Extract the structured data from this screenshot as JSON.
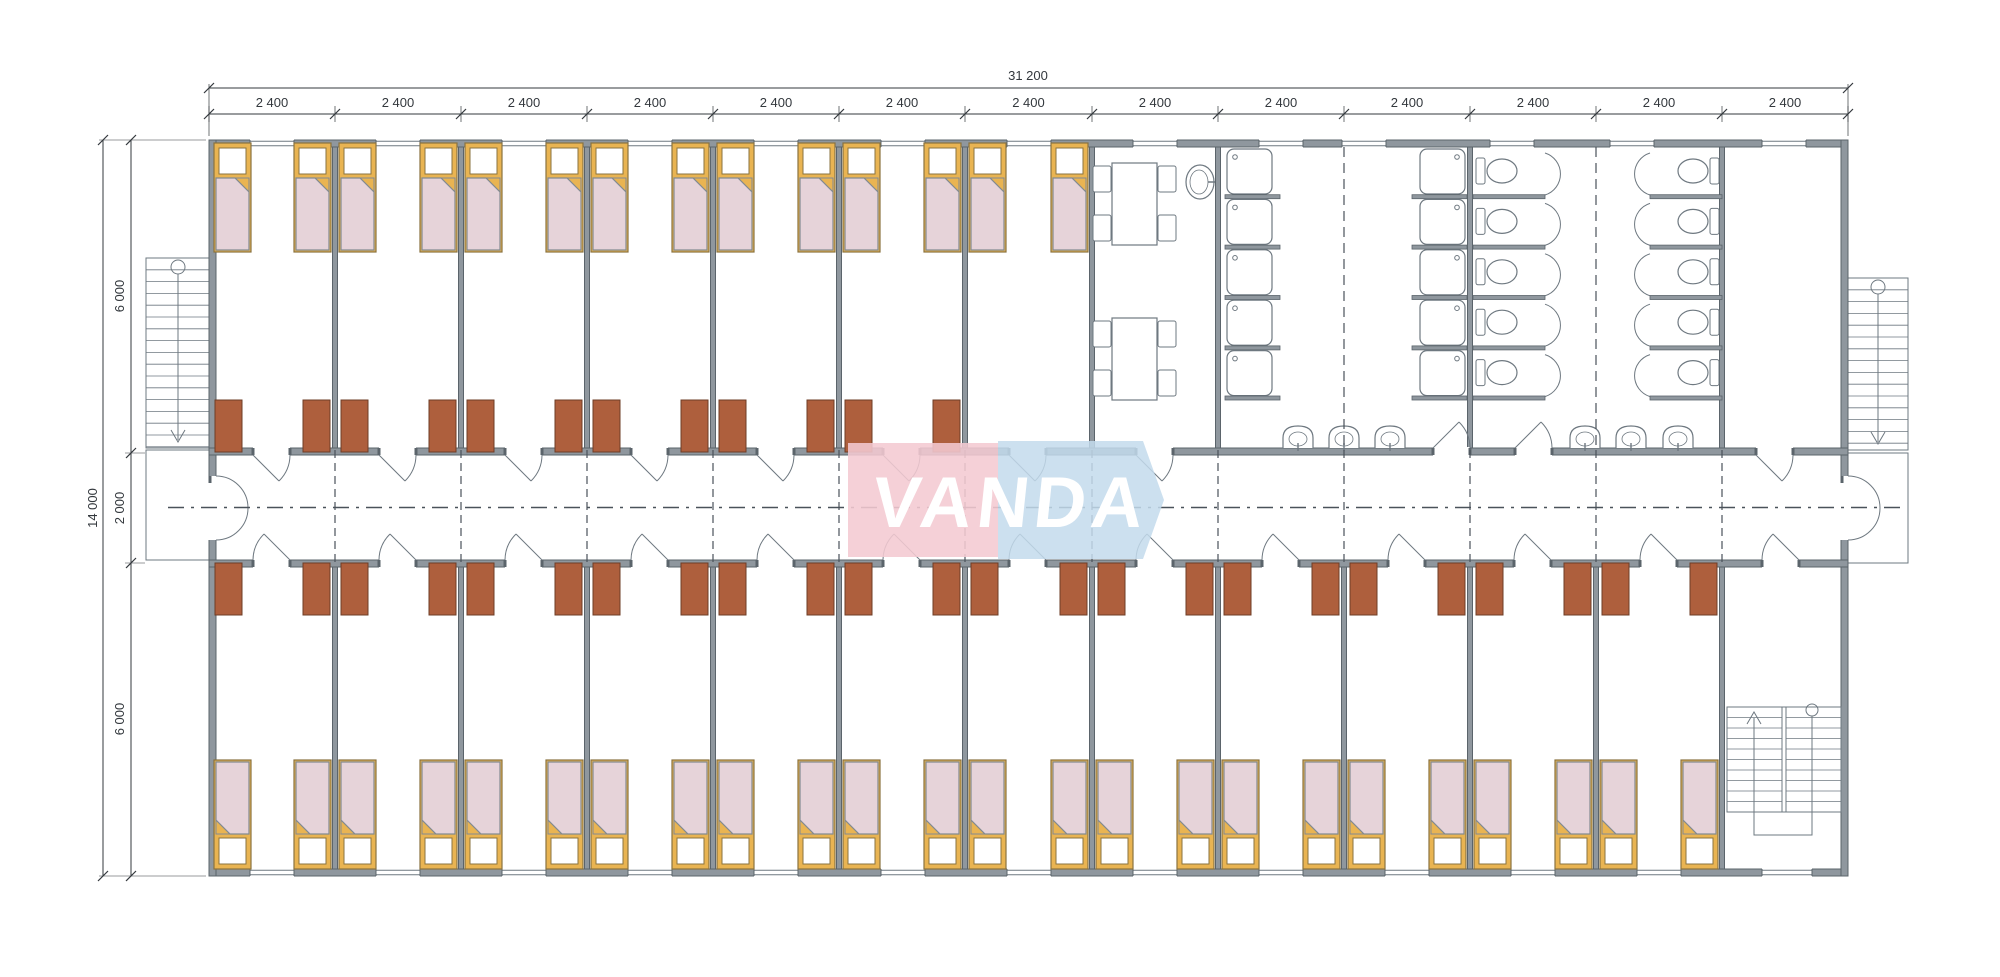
{
  "sheet": {
    "type": "architectural-floor-plan",
    "logo_text": "VANDA",
    "canvas": {
      "width": 2000,
      "height": 977
    }
  },
  "dimensions": {
    "overall_width": "31 200",
    "module_width": "2 400",
    "module_count": 13,
    "overall_depth": "14 000",
    "north_wing_depth": "6 000",
    "corridor_depth": "2 000",
    "south_wing_depth": "6 000"
  },
  "colors": {
    "wall_fill": "#8f979e",
    "wall_stroke": "#5b646b",
    "line": "#555d64",
    "thin_line": "#6e7880",
    "dash_line": "#4a525a",
    "bed_frame": "#e9b452",
    "bed_frame_stroke": "#8a7340",
    "bed_blanket": "#e6d3d9",
    "blanket_stroke": "#828a91",
    "pillow": "#ffffff",
    "wardrobe": "#ae5f3d",
    "wardrobe_stroke": "#6e3c26",
    "fixture_fill": "#ffffff",
    "dim_text": "#33383d",
    "logo_pink": "#f4c9d2",
    "logo_blue": "#c3daec",
    "logo_text_color": "#ffffff"
  },
  "inventory": {
    "bedrooms_north_wing": 7,
    "bedrooms_south_wing": 12,
    "beds": 38,
    "wardrobes": 36,
    "dining_tables": 2,
    "dining_chairs": 8,
    "dining_sinks": 1,
    "shower_stalls": 10,
    "toilet_stalls": 10,
    "wash_basins": 6,
    "external_staircases": 2,
    "internal_staircases": 1
  }
}
